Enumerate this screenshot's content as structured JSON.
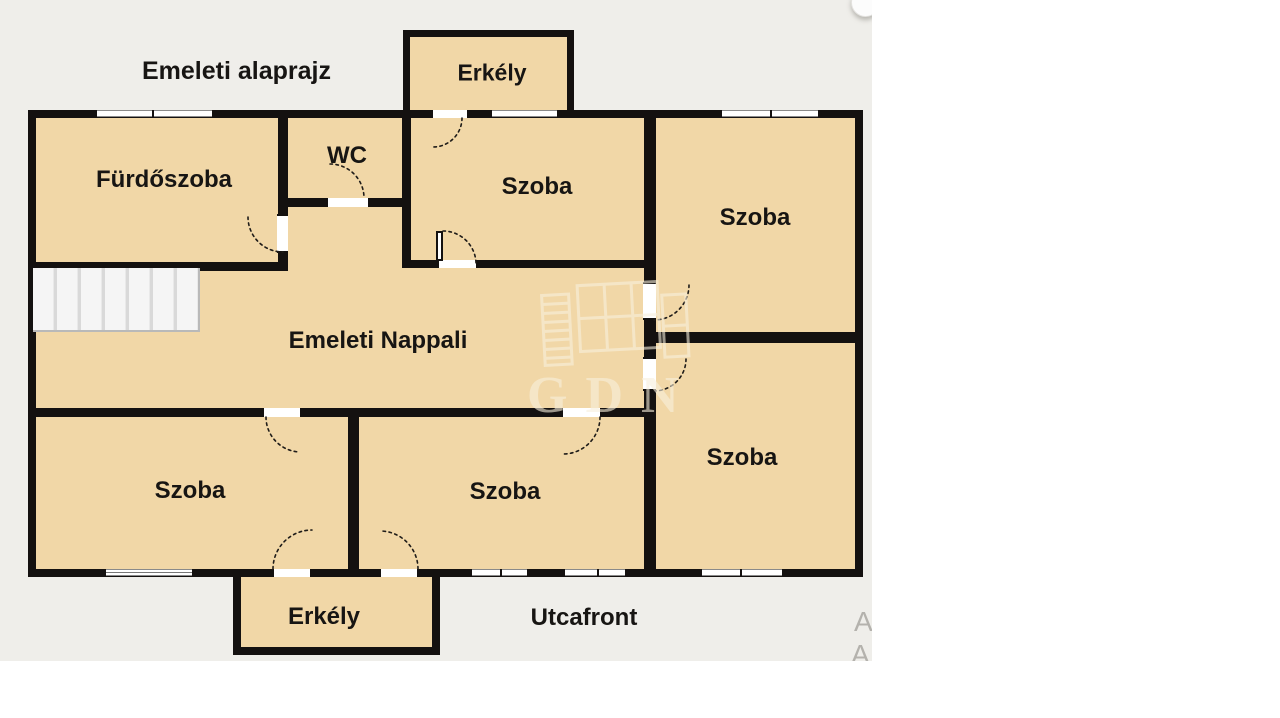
{
  "title": "Emeleti alaprajz",
  "labels": {
    "bathroom": "Fürdőszoba",
    "wc": "WC",
    "room_top_middle": "Szoba",
    "room_top_right": "Szoba",
    "living_room": "Emeleti Nappali",
    "room_bottom_left": "Szoba",
    "room_bottom_middle": "Szoba",
    "room_bottom_right": "Szoba",
    "balcony_top": "Erkély",
    "balcony_bottom": "Erkély",
    "street_front": "Utcafront"
  },
  "watermark": {
    "text": "GDN"
  },
  "edge_cropped_text": {
    "line1": "A",
    "line2": "A"
  },
  "colors": {
    "canvas": "#ffffff",
    "background": "#efeeea",
    "room_fill": "#f1d7a7",
    "wall": "#141110",
    "label": "#171513",
    "watermark_cream": "#f8f0dd",
    "cropped_text": "#b4b2ad"
  }
}
